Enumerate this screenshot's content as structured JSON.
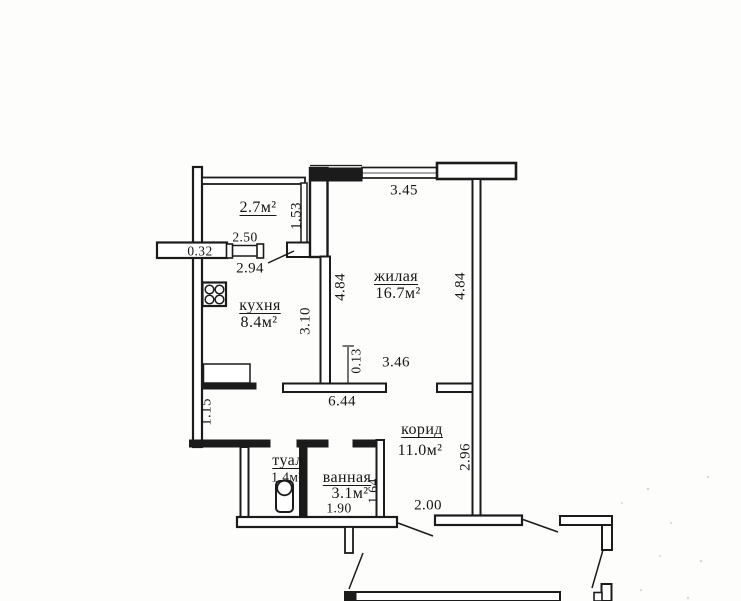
{
  "document": {
    "type": "apartment floor plan (scanned)",
    "language": "ru"
  },
  "colors": {
    "background": "#fdfdfc",
    "ink": "#1b1b1b"
  },
  "rooms": {
    "balcony": {
      "area_label": "2.7м²"
    },
    "kitchen": {
      "name": "кухня",
      "area": "8.4м²"
    },
    "living": {
      "name": "жилая",
      "area": "16.7м²"
    },
    "toilet": {
      "name": "туал",
      "area": "1.4м²"
    },
    "bathroom": {
      "name": "ванная",
      "area": "3.1м²"
    },
    "corridor": {
      "name": "корид",
      "area": "11.0м²"
    }
  },
  "dimensions": {
    "horizontal": {
      "top_window": "3.45",
      "balcony_window": "2.50",
      "exterior_wall": "0.32",
      "kitchen_width": "2.94",
      "living_lower_width": "3.46",
      "apartment_width": "6.44",
      "bathroom_width": "1.90",
      "entry_opening": "2.00"
    },
    "vertical": {
      "balcony_depth": "1.53",
      "living_height_left": "4.84",
      "living_height_right": "4.84",
      "kitchen_height": "3.10",
      "wall_offset": "0.13",
      "kitchen_lower": "1.15",
      "corridor_height": "2.96",
      "bathroom_depth": "1.64"
    }
  },
  "fixtures": {
    "stove": "4-burner stove",
    "toilet": "toilet bowl with tank"
  }
}
